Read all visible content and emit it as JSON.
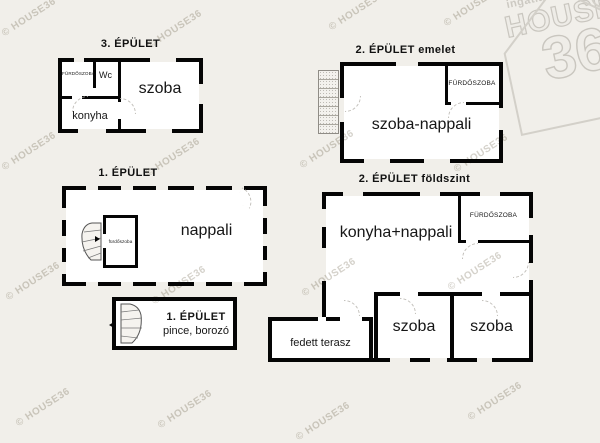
{
  "watermark": {
    "text": "© HOUSE36"
  },
  "logo": {
    "network": "ingatlanhálózat",
    "brand": "HOUSE",
    "number": "36"
  },
  "colors": {
    "background": "#f1efea",
    "wall": "#050505",
    "floor": "#ffffff",
    "watermark": "#d5d2cb"
  },
  "buildings": {
    "building3": {
      "title": "3. ÉPÜLET",
      "rooms": {
        "bathroom": "FÜRDŐSZOBA",
        "wc": "Wc",
        "room": "szoba",
        "kitchen": "konyha"
      }
    },
    "building2_upper": {
      "title": "2. ÉPÜLET emelet",
      "rooms": {
        "bathroom": "FÜRDŐSZOBA",
        "living": "szoba-nappali"
      }
    },
    "building1": {
      "title": "1. ÉPÜLET",
      "rooms": {
        "living": "nappali",
        "bathroom": "fürdőszoba"
      }
    },
    "building2_ground": {
      "title": "2. ÉPÜLET földszint",
      "rooms": {
        "kitchen_living": "konyha+nappali",
        "bathroom": "FÜRDŐSZOBA",
        "room1": "szoba",
        "room2": "szoba",
        "terrace": "fedett terasz"
      }
    },
    "building1_cellar": {
      "title": "1. ÉPÜLET",
      "subtitle": "pince, borozó"
    }
  }
}
